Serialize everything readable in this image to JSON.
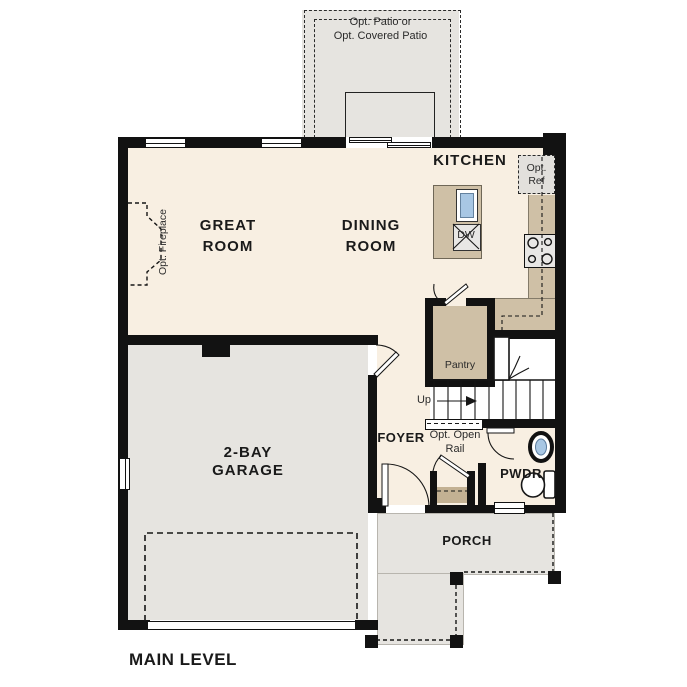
{
  "plan": {
    "title": "MAIN LEVEL"
  },
  "labels": {
    "patio_line1": "Opt. Patio or",
    "patio_line2": "Opt. Covered Patio",
    "kitchen": "KITCHEN",
    "great_line1": "GREAT",
    "great_line2": "ROOM",
    "dining_line1": "DINING",
    "dining_line2": "ROOM",
    "garage_line1": "2-BAY",
    "garage_line2": "GARAGE",
    "foyer": "FOYER",
    "pwdr": "PWDR",
    "porch": "PORCH",
    "pantry": "Pantry",
    "up": "Up",
    "dw": "DW",
    "opt_ref_line1": "Opt.",
    "opt_ref_line2": "Ref",
    "opt_open_rail_line1": "Opt. Open",
    "opt_open_rail_line2": "Rail",
    "opt_fireplace": "Opt. Fireplace"
  },
  "colors": {
    "floor": "#f8efe2",
    "concrete": "#e6e4e0",
    "counter": "#cfc0a6",
    "counter_dark": "#c3b193",
    "wall": "#121212",
    "ink": "#1a1a1a",
    "sink_blue": "#a8c7e4",
    "appliance": "#e8e7e5",
    "optref_bg": "#e2e0dc"
  }
}
